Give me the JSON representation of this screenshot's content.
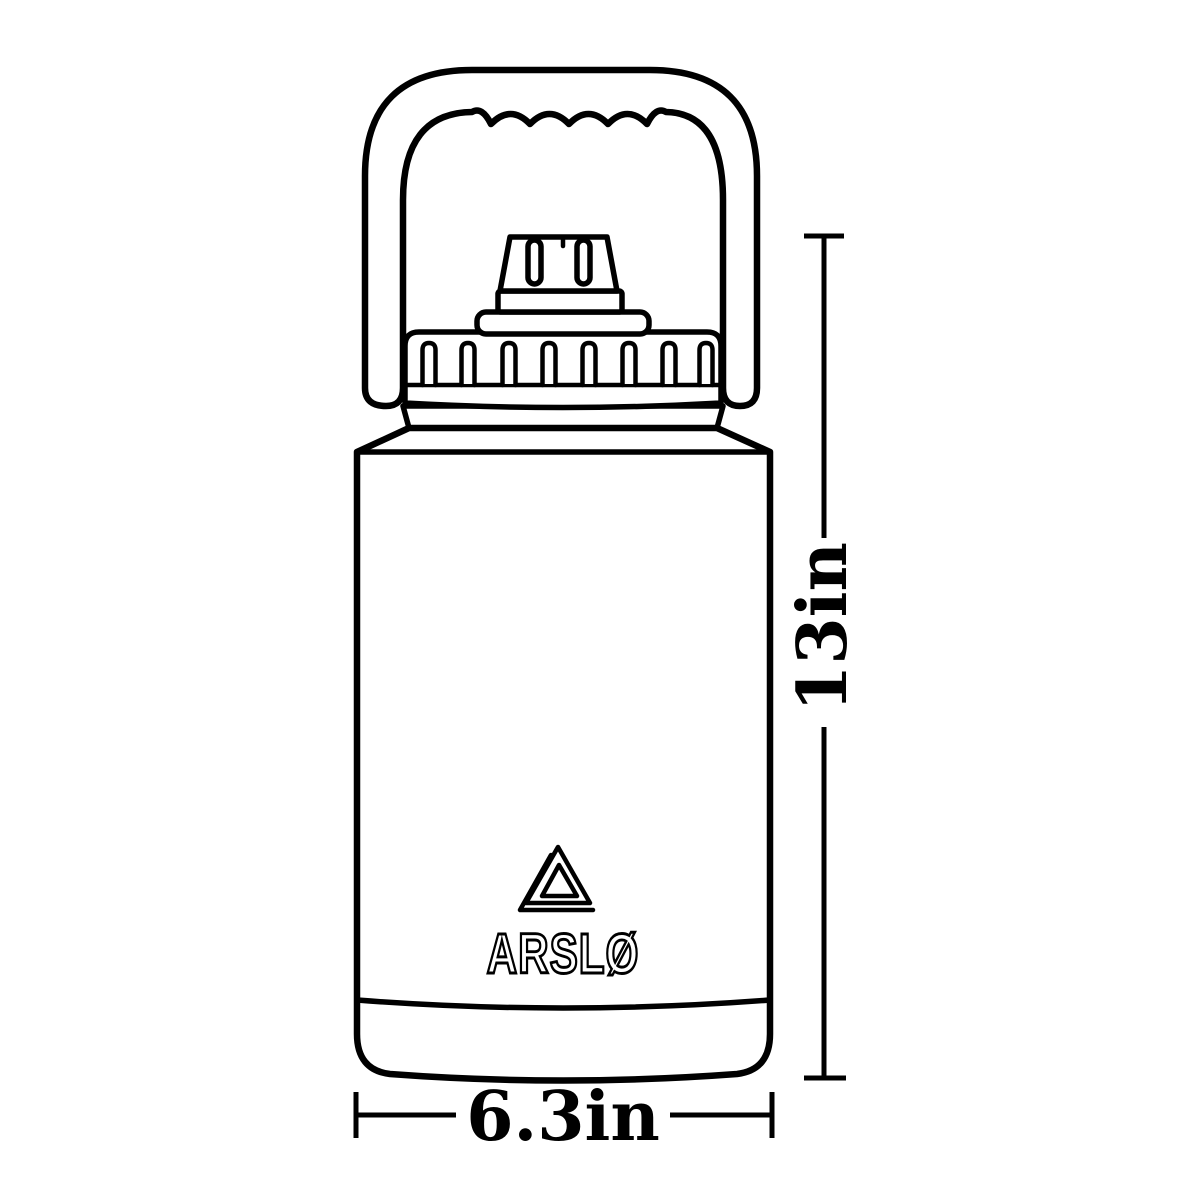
{
  "canvas": {
    "background": "#ffffff",
    "line_color": "#000000"
  },
  "brand": {
    "logo_text": "ARSLØ",
    "logo_icon": "nested-triangle-delta"
  },
  "dimensions": {
    "height_label": "13in",
    "width_label": "6.3in"
  }
}
